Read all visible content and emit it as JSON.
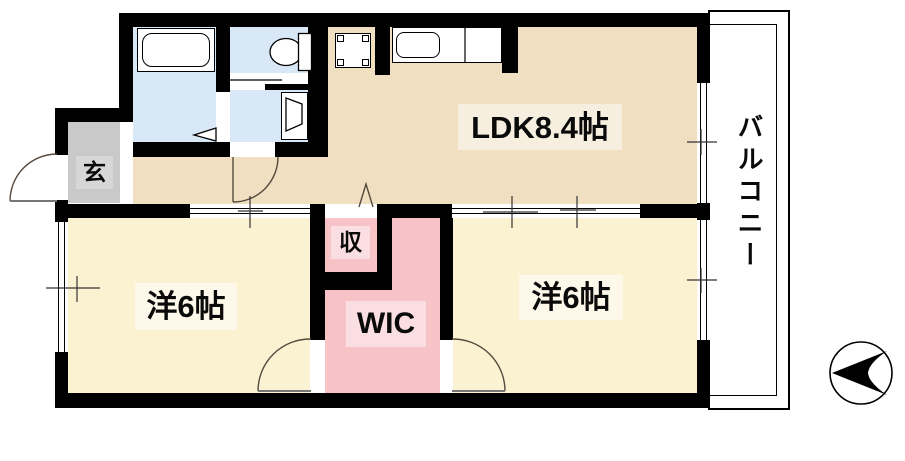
{
  "plan": {
    "rooms": [
      {
        "id": "ldk",
        "label": "LDK8.4帖"
      },
      {
        "id": "bedroom_left",
        "label": "洋6帖"
      },
      {
        "id": "bedroom_right",
        "label": "洋6帖"
      },
      {
        "id": "wic",
        "label": "WIC"
      },
      {
        "id": "storage",
        "label": "収"
      },
      {
        "id": "entrance",
        "label": "玄"
      },
      {
        "id": "balcony",
        "label": "バルコニー"
      }
    ],
    "fixtures": [
      "bathtub",
      "toilet",
      "vanity-sink",
      "kitchen-sink-counter",
      "washing-machine-space",
      "north-arrow"
    ],
    "colors": {
      "ldk_floor": "#f0dfc0",
      "bedroom_floor": "#fbf2d2",
      "closet_floor": "#f8c3c7",
      "wet_area_floor": "#d8e8f7",
      "entrance_floor": "#c9c9c9",
      "wall": "#000000",
      "door_arc": "#554a3e"
    }
  }
}
